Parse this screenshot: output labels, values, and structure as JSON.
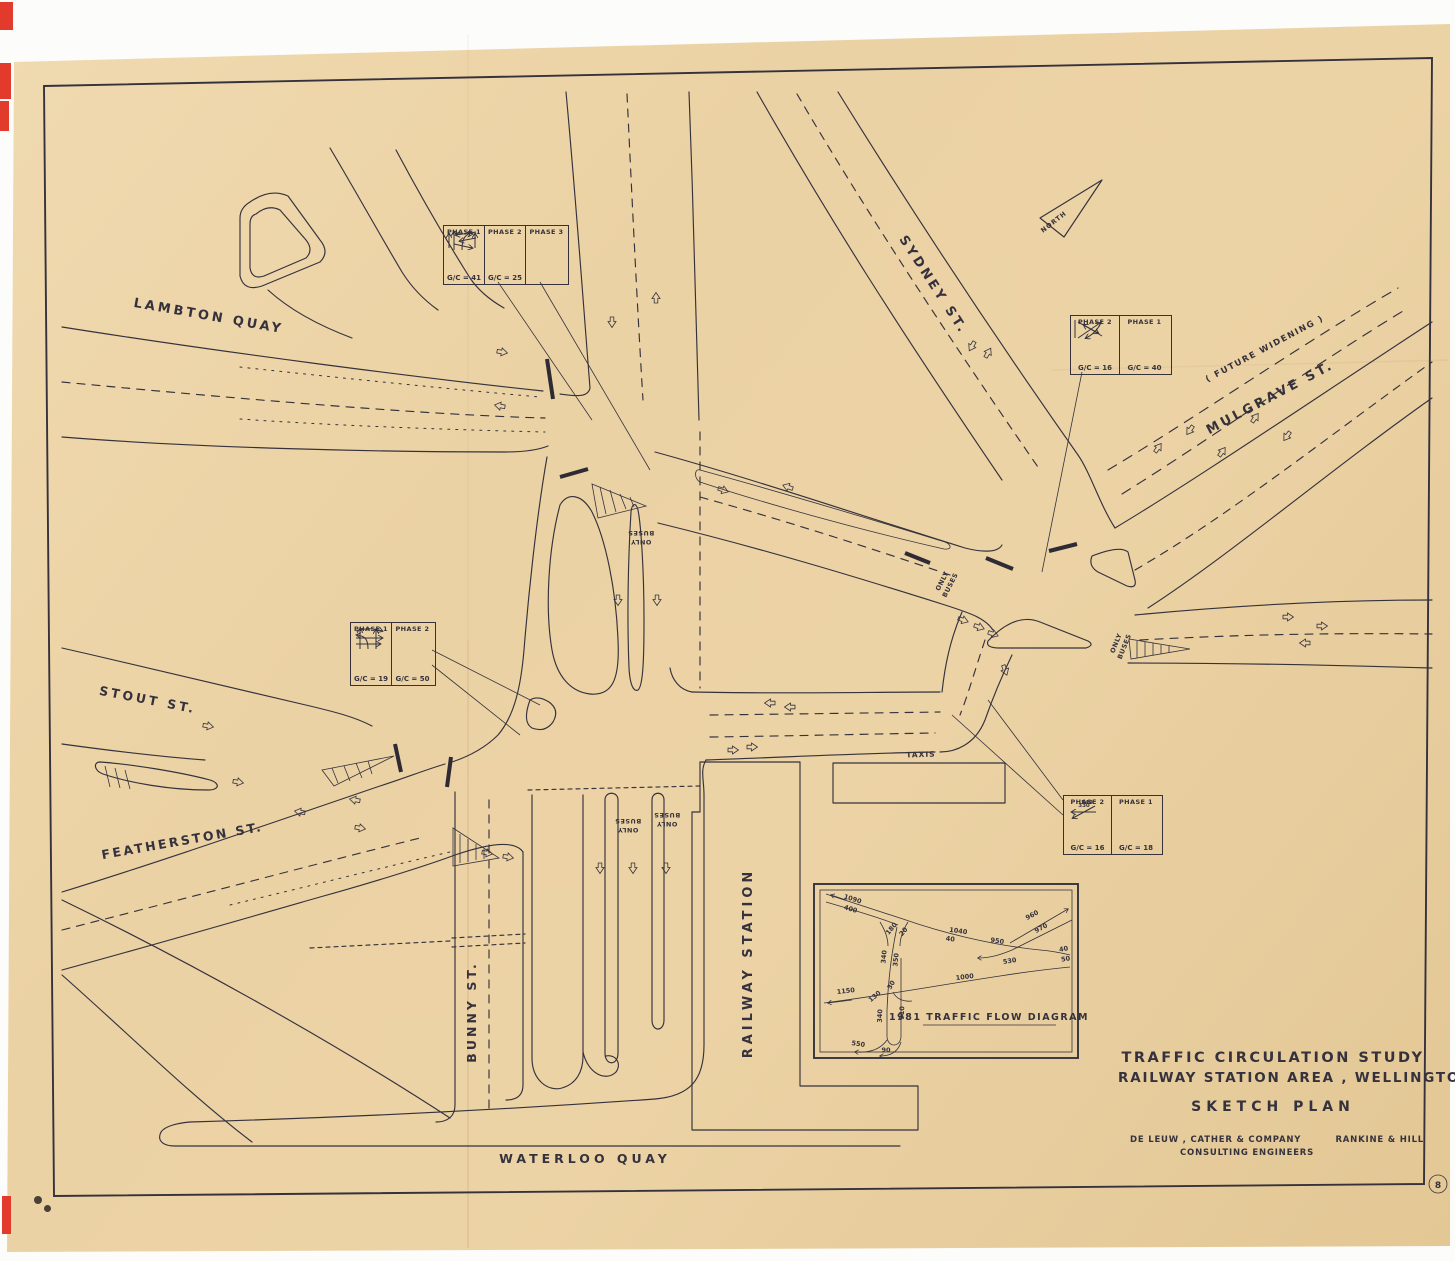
{
  "title_block": {
    "line1": "TRAFFIC CIRCULATION STUDY",
    "line2": "RAILWAY STATION AREA , WELLINGTON",
    "line3": "SKETCH PLAN",
    "firm_1": "DE LEUW , CATHER & COMPANY",
    "firm_2": "RANKINE & HILL",
    "firm_3": "CONSULTING ENGINEERS",
    "sheet_no": "8"
  },
  "street_labels": {
    "lambton_quay": "LAMBTON QUAY",
    "sydney_st": "SYDNEY ST.",
    "mulgrave_st": "MULGRAVE ST.",
    "future_widening": "( FUTURE  WIDENING )",
    "stout_st": "STOUT ST.",
    "featherston_st": "FEATHERSTON ST.",
    "bunny_st": "BUNNY ST.",
    "waterloo_quay": "WATERLOO QUAY",
    "railway_station": "RAILWAY STATION",
    "taxis": "TAXIS",
    "north": "NORTH",
    "only": "ONLY",
    "buses": "BUSES"
  },
  "phase_boxes": [
    {
      "name": "lambton-quay-signals",
      "cells": [
        {
          "label": "PHASE 1",
          "ratio": "G/C = 41"
        },
        {
          "label": "PHASE 2",
          "ratio": "G/C = 25"
        },
        {
          "label": "PHASE 3",
          "ratio": ""
        }
      ]
    },
    {
      "name": "mulgrave-st-signals",
      "cells": [
        {
          "label": "PHASE 2",
          "ratio": "G/C = 16"
        },
        {
          "label": "PHASE 1",
          "ratio": "G/C = 40"
        }
      ]
    },
    {
      "name": "featherston-st-signals",
      "cells": [
        {
          "label": "PHASE 1",
          "ratio": "G/C = 19"
        },
        {
          "label": "PHASE 2",
          "ratio": "G/C = 50"
        }
      ]
    },
    {
      "name": "station-front-signals",
      "cells": [
        {
          "label": "PHASE 2",
          "ratio": "G/C = 16",
          "arrow_label": "540"
        },
        {
          "label": "PHASE 1",
          "ratio": "G/C = 18",
          "arrow_label": "330"
        }
      ]
    }
  ],
  "inset": {
    "title": "1981 TRAFFIC FLOW DIAGRAM",
    "flows": [
      "1090",
      "400",
      "1040",
      "40",
      "950",
      "960",
      "970",
      "530",
      "40",
      "50",
      "1000",
      "1150",
      "130",
      "340",
      "350",
      "30",
      "340",
      "910",
      "550",
      "90",
      "180",
      "20"
    ]
  }
}
